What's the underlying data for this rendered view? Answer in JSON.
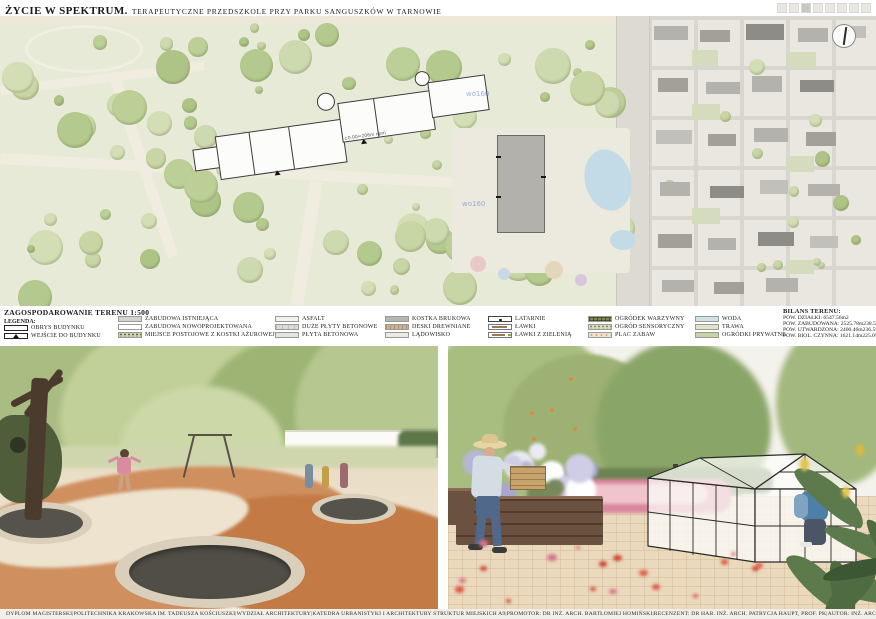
{
  "header": {
    "title_main": "ŻYCIE W SPEKTRUM.",
    "title_sub": "TERAPEUTYCZNE PRZEDSZKOLE PRZY PARKU SANGUSZKÓW W TARNOWIE"
  },
  "plan": {
    "elevation_label": "±0.00=206m npm",
    "watermark": "wo160"
  },
  "legend": {
    "title": "ZAGOSPODAROWANIE TERENU 1:500",
    "legenda_label": "LEGENDA:",
    "col1": [
      {
        "label": "OBRYS BUDYNKU"
      },
      {
        "label": "WEJŚCIE DO BUDYNKU"
      }
    ],
    "col2": [
      {
        "label": "ZABUDOWA ISTNIEJĄCA"
      },
      {
        "label": "ZABUDOWA NOWOPROJEKTOWANA"
      },
      {
        "label": "MIEJSCE POSTOJOWE Z KOSTKI AŻUROWEJ"
      }
    ],
    "col3": [
      {
        "label": "ASFALT"
      },
      {
        "label": "DUŻE PŁYTY BETONOWE"
      },
      {
        "label": "PŁYTA BETONOWA"
      }
    ],
    "col4": [
      {
        "label": "KOSTKA BRUKOWA"
      },
      {
        "label": "DESKI DREWNIANE"
      },
      {
        "label": "LĄDOWISKO"
      }
    ],
    "col5": [
      {
        "label": "LATARNIE"
      },
      {
        "label": "ŁAWKI"
      },
      {
        "label": "ŁAWKI Z ZIELENIĄ"
      }
    ],
    "col6": [
      {
        "label": "OGRÓDEK WARZYWNY"
      },
      {
        "label": "OGRÓD SENSORYCZNY"
      },
      {
        "label": "PLAC ZABAW"
      }
    ],
    "col7": [
      {
        "label": "WODA"
      },
      {
        "label": "TRAWA"
      },
      {
        "label": "OGRÓDKI PRYWATNE"
      }
    ]
  },
  "bilans": {
    "title": "BILANS TERENU:",
    "rows": [
      {
        "text": "POW. DZIAŁKI: 6547.56m2",
        "pct": ""
      },
      {
        "text": "POW. ZABUDOWANA: 2525.78m2",
        "pct": "38.5%"
      },
      {
        "text": "POW. UTWARDZONA: 2400.46m2",
        "pct": "36.5%"
      },
      {
        "text": "POW. BIOL. CZYNNA: 1621.14m2",
        "pct": "25.0%"
      }
    ]
  },
  "footer": {
    "separator": "|",
    "items": [
      "DYPLOM MAGISTERSKI",
      "POLITECHNIKA KRAKOWSKA IM. TADEUSZA KOŚCIUSZKI",
      "WYDZIAŁ ARCHITEKTURY",
      "KATEDRA URBANISTYKI I ARCHITEKTURY STRUKTUR MIEJSKICH A9",
      "PROMOTOR: DR INŻ. ARCH. BARTŁOMIEJ HOMIŃSKI",
      "RECENZENT: DR HAB. INŻ. ARCH. PATRYCJA HAUPT, PROF. PK",
      "AUTOR: INŻ. ARCH. DOMINIKA SUCHOWSKA",
      "2022/23"
    ]
  },
  "colors": {
    "park_green": "#e6ead6",
    "water": "#c2dbe6",
    "terracotta_playground": "#cb8350",
    "accent_pink_flowers": "#dd8fa2",
    "poppy_red": "#d2493a"
  }
}
